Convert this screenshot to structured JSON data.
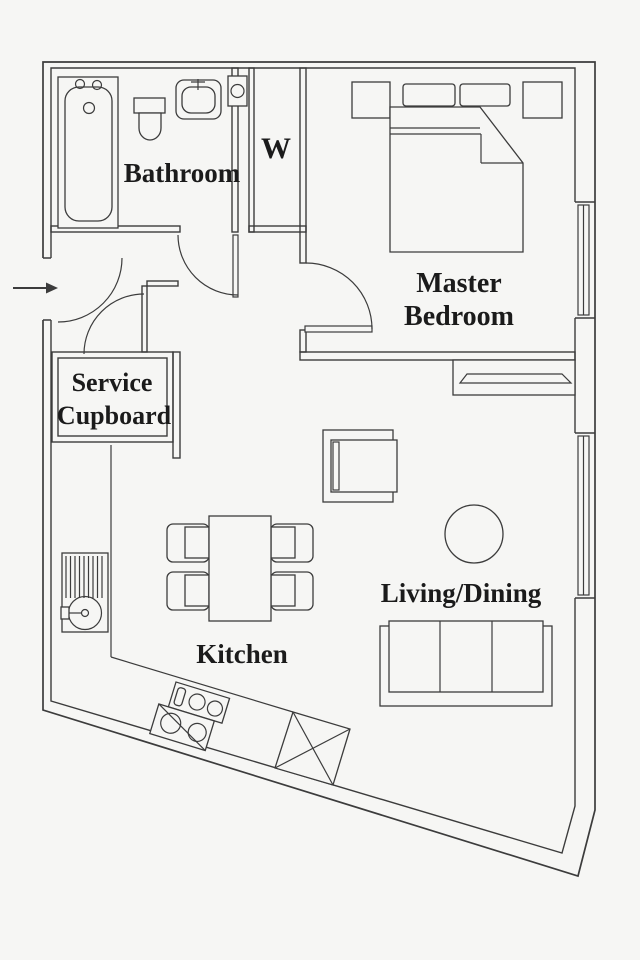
{
  "title": "Apartment floor plan",
  "colors": {
    "background": "#f6f6f4",
    "line": "#3c3c3c",
    "text": "#1b1b1b"
  },
  "rooms": {
    "bathroom": {
      "label": "Bathroom"
    },
    "wardrobe": {
      "label": "W"
    },
    "master_bedroom": {
      "label_line1": "Master",
      "label_line2": "Bedroom"
    },
    "service_cupboard": {
      "label_line1": "Service",
      "label_line2": "Cupboard"
    },
    "kitchen": {
      "label": "Kitchen"
    },
    "living_dining": {
      "label": "Living/Dining"
    }
  },
  "fixtures": [
    "entrance-arrow",
    "entrance-door",
    "bathtub",
    "toilet",
    "bathroom-basin",
    "vent-box",
    "bathroom-door",
    "wardrobe-closet",
    "double-bed",
    "pillows",
    "bedside-table-left",
    "bedside-table-right",
    "bedroom-door",
    "bedroom-window",
    "living-window",
    "radiator-shelf",
    "tv-unit",
    "round-table",
    "sofa",
    "dining-table",
    "dining-chairs",
    "kitchen-counter",
    "kitchen-sink",
    "hob",
    "appliance-cross-box",
    "service-cupboard-door"
  ]
}
